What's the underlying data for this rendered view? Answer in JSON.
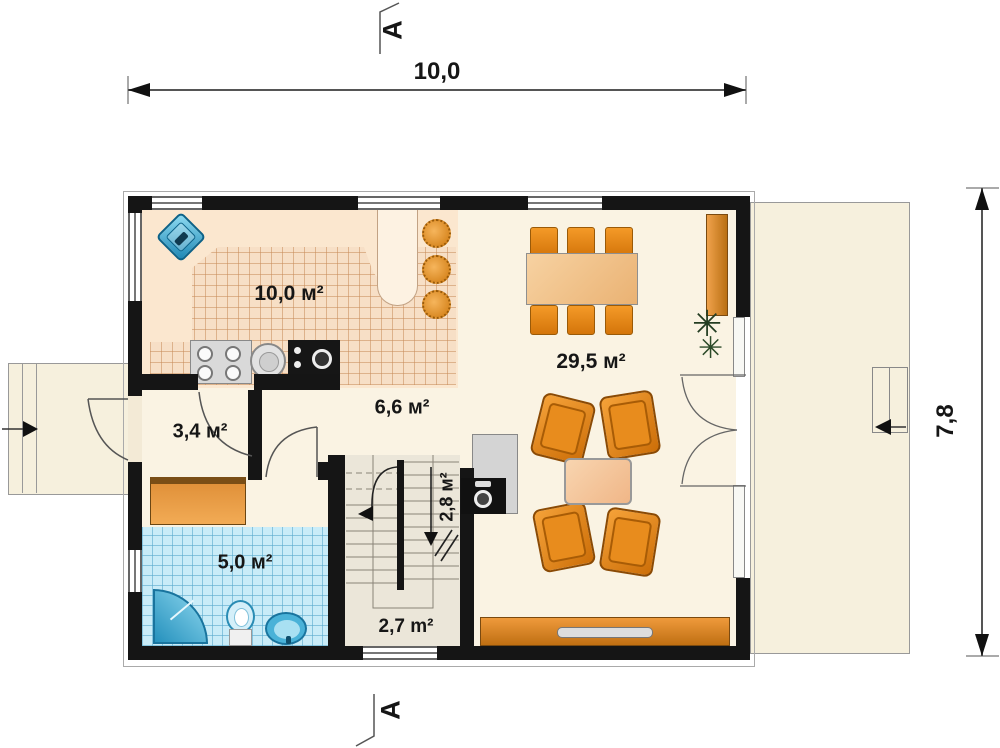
{
  "plan": {
    "type": "house ground-floor plan",
    "dimensions": {
      "width": "10,0",
      "height": "7,8"
    },
    "section_markers": {
      "top": "A",
      "bottom": "A"
    },
    "rooms": {
      "kitchen": {
        "label": "10,0 м²"
      },
      "living_dining": {
        "label": "29,5 м²"
      },
      "hallway": {
        "label": "6,6 м²"
      },
      "entry": {
        "label": "3,4 м²"
      },
      "bathroom": {
        "label": "5,0 м²"
      },
      "staircase": {
        "label": "2,8 м²"
      },
      "staircase_lower": {
        "label": "2,7 m²"
      }
    },
    "icons": {
      "plant_glyph": "✳"
    },
    "colors": {
      "wall": "#151515",
      "floor": "#faf3e3",
      "kitchen_floor": "#fbe7cf",
      "kitchen_tile": "#f7dfc6",
      "bathroom_tile": "#c9ecf8",
      "furniture_orange": "#e8861c",
      "fixture_blue": "#3ba8d0",
      "terrace": "#f6f0dd",
      "dimension_line": "#555555"
    }
  }
}
